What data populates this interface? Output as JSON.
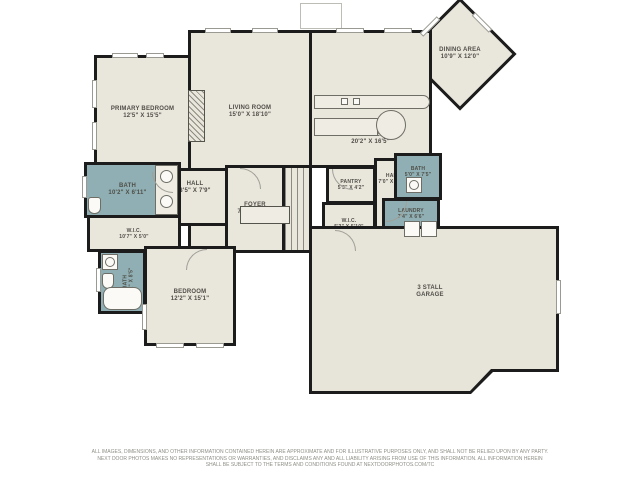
{
  "colors": {
    "wall": "#1c1c1c",
    "floor": "#e9e6dc",
    "bath_fill": "#8fafb4",
    "background": "#ffffff",
    "label_text": "#4f4e47"
  },
  "rooms": [
    {
      "label": "PRIMARY BEDROOM",
      "dims": "12'5\" X 15'5\""
    },
    {
      "label": "LIVING ROOM",
      "dims": "15'0\" X 18'10\""
    },
    {
      "label": "KITCHEN",
      "dims": "20'2\" X 16'5\""
    },
    {
      "label": "DINING AREA",
      "dims": "10'9\" X 12'0\""
    },
    {
      "label": "HALL",
      "dims": "8'5\" X 7'9\""
    },
    {
      "label": "FOYER",
      "dims": "7'0\" X 10'8\""
    },
    {
      "label": "PANTRY",
      "dims": "5'3\" X 4'2\""
    },
    {
      "label": "HALL",
      "dims": "7'0\" X 11'9\""
    },
    {
      "label": "W.I.C.",
      "dims": "5'3\" X 5'10\""
    },
    {
      "label": "BATH",
      "dims": "5'0\" X 7'5\""
    },
    {
      "label": "LAUNDRY",
      "dims": "7'4\" X 6'6\""
    },
    {
      "label": "BATH",
      "dims": "10'2\" X 6'11\""
    },
    {
      "label": "W.I.C.",
      "dims": "10'7\" X 5'0\""
    },
    {
      "label": "BATH",
      "dims": "4'11\" X 8'5\""
    },
    {
      "label": "BEDROOM",
      "dims": "12'2\" X 15'1\""
    },
    {
      "label": "3 STALL",
      "dims": "GARAGE"
    }
  ],
  "disclaimer": {
    "line1": "ALL IMAGES, DIMENSIONS, AND OTHER INFORMATION CONTAINED HEREIN ARE APPROXIMATE AND FOR ILLUSTRATIVE PURPOSES ONLY, AND SHALL NOT BE RELIED UPON BY ANY PARTY.",
    "line2": "NEXT DOOR PHOTOS MAKES NO REPRESENTATIONS OR WARRANTIES, AND DISCLAIMS ANY AND ALL LIABILITY ARISING FROM USE OF THIS INFORMATION. ALL INFORMATION HEREIN",
    "line3": "SHALL BE SUBJECT TO THE TERMS AND CONDITIONS FOUND AT NEXTDOORPHOTOS.COM/TC"
  }
}
